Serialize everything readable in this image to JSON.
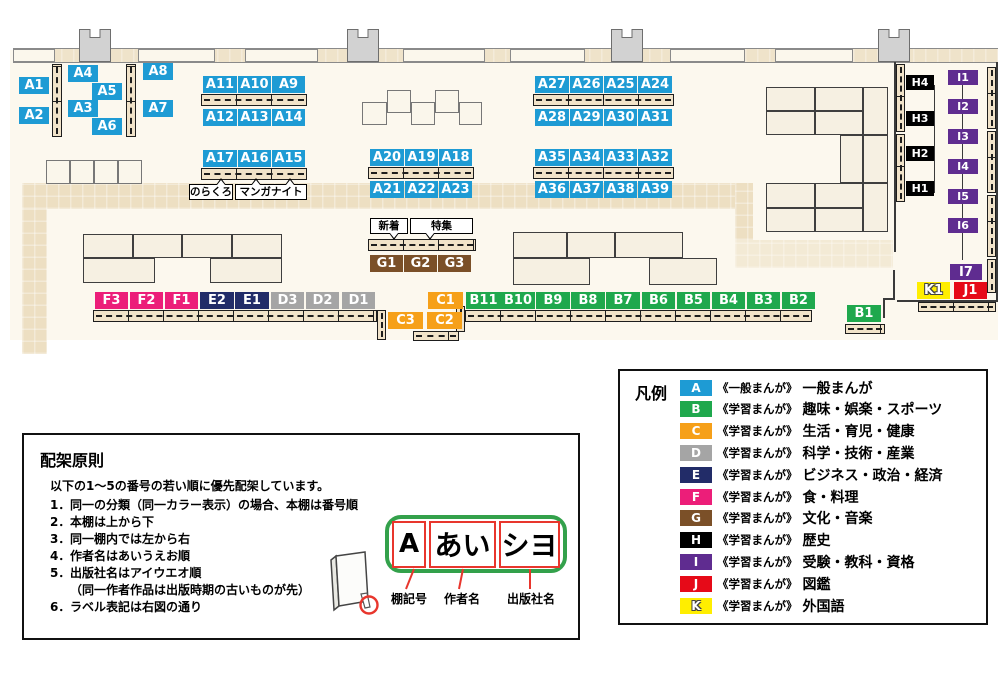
{
  "colors": {
    "A": "#1E9BD4",
    "B": "#1FA84D",
    "C": "#F6A019",
    "D": "#A5A5A5",
    "E": "#222C68",
    "F": "#EC1E79",
    "G": "#7B5028",
    "H": "#000000",
    "I": "#5F2C90",
    "J": "#E60A18",
    "K": "#FFEE00"
  },
  "map": {
    "furniture": [
      {
        "t": "floor",
        "x": 10,
        "y": 50,
        "w": 988,
        "h": 290
      },
      {
        "t": "band",
        "x": 22,
        "y": 183,
        "w": 713,
        "h": 26
      },
      {
        "t": "band",
        "x": 22,
        "y": 209,
        "w": 25,
        "h": 145
      },
      {
        "t": "band",
        "x": 735,
        "y": 183,
        "w": 18,
        "h": 57
      },
      {
        "t": "band",
        "x": 735,
        "y": 240,
        "w": 158,
        "h": 28,
        "light": true
      },
      {
        "t": "wallstrip",
        "x": 13,
        "y": 48,
        "w": 985,
        "h": 15
      },
      {
        "t": "window",
        "x": 13,
        "y": 49,
        "w": 42,
        "h": 13
      },
      {
        "t": "window",
        "x": 138,
        "y": 49,
        "w": 77,
        "h": 13
      },
      {
        "t": "window",
        "x": 245,
        "y": 49,
        "w": 73,
        "h": 13
      },
      {
        "t": "window",
        "x": 403,
        "y": 49,
        "w": 82,
        "h": 13
      },
      {
        "t": "window",
        "x": 510,
        "y": 49,
        "w": 75,
        "h": 13
      },
      {
        "t": "window",
        "x": 670,
        "y": 49,
        "w": 75,
        "h": 13
      },
      {
        "t": "window",
        "x": 775,
        "y": 49,
        "w": 78,
        "h": 13
      },
      {
        "t": "pillar",
        "x": 79,
        "y": 29,
        "w": 32,
        "h": 33
      },
      {
        "t": "pillar",
        "x": 347,
        "y": 29,
        "w": 32,
        "h": 33
      },
      {
        "t": "pillar",
        "x": 611,
        "y": 29,
        "w": 32,
        "h": 33
      },
      {
        "t": "pillar",
        "x": 878,
        "y": 29,
        "w": 32,
        "h": 33
      },
      {
        "t": "block",
        "x": 83,
        "y": 234,
        "w": 50,
        "h": 24
      },
      {
        "t": "block",
        "x": 133,
        "y": 234,
        "w": 49,
        "h": 24
      },
      {
        "t": "block",
        "x": 182,
        "y": 234,
        "w": 50,
        "h": 24
      },
      {
        "t": "block",
        "x": 232,
        "y": 234,
        "w": 50,
        "h": 24
      },
      {
        "t": "block",
        "x": 83,
        "y": 258,
        "w": 72,
        "h": 25
      },
      {
        "t": "block",
        "x": 210,
        "y": 258,
        "w": 72,
        "h": 25
      },
      {
        "t": "block",
        "x": 513,
        "y": 232,
        "w": 54,
        "h": 26
      },
      {
        "t": "block",
        "x": 567,
        "y": 232,
        "w": 48,
        "h": 26
      },
      {
        "t": "block",
        "x": 615,
        "y": 232,
        "w": 68,
        "h": 26
      },
      {
        "t": "block",
        "x": 513,
        "y": 258,
        "w": 77,
        "h": 27
      },
      {
        "t": "block",
        "x": 649,
        "y": 258,
        "w": 68,
        "h": 27
      },
      {
        "t": "block",
        "x": 766,
        "y": 87,
        "w": 49,
        "h": 24
      },
      {
        "t": "block",
        "x": 815,
        "y": 87,
        "w": 48,
        "h": 24
      },
      {
        "t": "block",
        "x": 766,
        "y": 111,
        "w": 49,
        "h": 24
      },
      {
        "t": "block",
        "x": 815,
        "y": 111,
        "w": 48,
        "h": 24
      },
      {
        "t": "block",
        "x": 863,
        "y": 87,
        "w": 25,
        "h": 48
      },
      {
        "t": "block",
        "x": 840,
        "y": 135,
        "w": 23,
        "h": 48
      },
      {
        "t": "block",
        "x": 863,
        "y": 135,
        "w": 25,
        "h": 48
      },
      {
        "t": "block",
        "x": 766,
        "y": 183,
        "w": 49,
        "h": 25
      },
      {
        "t": "block",
        "x": 815,
        "y": 183,
        "w": 48,
        "h": 25
      },
      {
        "t": "block",
        "x": 766,
        "y": 208,
        "w": 49,
        "h": 24
      },
      {
        "t": "block",
        "x": 815,
        "y": 208,
        "w": 48,
        "h": 24
      },
      {
        "t": "block",
        "x": 863,
        "y": 183,
        "w": 25,
        "h": 49
      },
      {
        "t": "sq",
        "x": 46,
        "y": 160,
        "w": 24,
        "h": 24
      },
      {
        "t": "sq",
        "x": 70,
        "y": 160,
        "w": 24,
        "h": 24
      },
      {
        "t": "sq",
        "x": 94,
        "y": 160,
        "w": 24,
        "h": 24
      },
      {
        "t": "sq",
        "x": 118,
        "y": 160,
        "w": 24,
        "h": 24
      },
      {
        "t": "sq",
        "x": 362,
        "y": 102,
        "w": 25,
        "h": 23
      },
      {
        "t": "sq",
        "x": 387,
        "y": 90,
        "w": 24,
        "h": 23
      },
      {
        "t": "sq",
        "x": 411,
        "y": 102,
        "w": 24,
        "h": 23
      },
      {
        "t": "sq",
        "x": 435,
        "y": 90,
        "w": 24,
        "h": 23
      },
      {
        "t": "sq",
        "x": 459,
        "y": 102,
        "w": 23,
        "h": 23
      },
      {
        "t": "vstrip",
        "x": 52,
        "y": 64,
        "w": 10,
        "h": 73
      },
      {
        "t": "vstrip",
        "x": 126,
        "y": 64,
        "w": 10,
        "h": 73
      },
      {
        "t": "hstrip",
        "x": 201,
        "y": 94,
        "w": 106,
        "h": 12
      },
      {
        "t": "hstrip",
        "x": 201,
        "y": 168,
        "w": 106,
        "h": 12
      },
      {
        "t": "hstrip",
        "x": 533,
        "y": 94,
        "w": 141,
        "h": 12
      },
      {
        "t": "hstrip",
        "x": 368,
        "y": 167,
        "w": 106,
        "h": 12
      },
      {
        "t": "hstrip",
        "x": 533,
        "y": 167,
        "w": 141,
        "h": 12
      },
      {
        "t": "hstrip",
        "x": 368,
        "y": 239,
        "w": 108,
        "h": 12
      },
      {
        "t": "hstrip",
        "x": 93,
        "y": 310,
        "w": 284,
        "h": 12
      },
      {
        "t": "vstrip",
        "x": 377,
        "y": 310,
        "w": 9,
        "h": 30
      },
      {
        "t": "vstrip",
        "x": 456,
        "y": 306,
        "w": 9,
        "h": 26
      },
      {
        "t": "hstrip",
        "x": 413,
        "y": 331,
        "w": 46,
        "h": 10
      },
      {
        "t": "hstrip",
        "x": 465,
        "y": 310,
        "w": 347,
        "h": 12
      },
      {
        "t": "hstrip",
        "x": 845,
        "y": 324,
        "w": 40,
        "h": 10
      },
      {
        "t": "hstrip",
        "x": 918,
        "y": 302,
        "w": 78,
        "h": 10
      },
      {
        "t": "vstrip",
        "x": 896,
        "y": 64,
        "w": 9,
        "h": 68
      },
      {
        "t": "vstrip",
        "x": 896,
        "y": 134,
        "w": 9,
        "h": 68
      },
      {
        "t": "vstrip",
        "x": 987,
        "y": 67,
        "w": 9,
        "h": 62
      },
      {
        "t": "vstrip",
        "x": 987,
        "y": 131,
        "w": 9,
        "h": 62
      },
      {
        "t": "vstrip",
        "x": 987,
        "y": 195,
        "w": 9,
        "h": 62
      },
      {
        "t": "vstrip",
        "x": 987,
        "y": 259,
        "w": 9,
        "h": 34
      },
      {
        "t": "wline",
        "x": 894,
        "y": 62,
        "w": 2,
        "h": 190
      },
      {
        "t": "wline",
        "x": 893,
        "y": 270,
        "w": 2,
        "h": 30
      },
      {
        "t": "wline",
        "x": 883,
        "y": 298,
        "w": 12,
        "h": 2
      },
      {
        "t": "wline",
        "x": 883,
        "y": 300,
        "w": 2,
        "h": 18
      },
      {
        "t": "wline",
        "x": 897,
        "y": 300,
        "w": 100,
        "h": 2
      },
      {
        "t": "wline",
        "x": 996,
        "y": 62,
        "w": 2,
        "h": 240
      },
      {
        "t": "wline",
        "x": 934,
        "y": 85,
        "w": 1,
        "h": 108
      },
      {
        "t": "wline",
        "x": 962,
        "y": 82,
        "w": 1,
        "h": 178
      }
    ],
    "shelf_labels": [
      {
        "text": "A1",
        "x": 19,
        "y": 77,
        "w": 30,
        "h": 17
      },
      {
        "text": "A2",
        "x": 19,
        "y": 107,
        "w": 30,
        "h": 17
      },
      {
        "text": "A4",
        "x": 68,
        "y": 65,
        "w": 30,
        "h": 17
      },
      {
        "text": "A3",
        "x": 68,
        "y": 100,
        "w": 30,
        "h": 17
      },
      {
        "text": "A5",
        "x": 92,
        "y": 83,
        "w": 30,
        "h": 17
      },
      {
        "text": "A6",
        "x": 92,
        "y": 118,
        "w": 30,
        "h": 17
      },
      {
        "text": "A8",
        "x": 143,
        "y": 63,
        "w": 30,
        "h": 17
      },
      {
        "text": "A7",
        "x": 143,
        "y": 100,
        "w": 30,
        "h": 17
      },
      {
        "text": "A11",
        "x": 203,
        "y": 76,
        "w": 34,
        "h": 17
      },
      {
        "text": "A10",
        "x": 238,
        "y": 76,
        "w": 33,
        "h": 17
      },
      {
        "text": "A9",
        "x": 272,
        "y": 76,
        "w": 33,
        "h": 17
      },
      {
        "text": "A12",
        "x": 203,
        "y": 109,
        "w": 34,
        "h": 17
      },
      {
        "text": "A13",
        "x": 238,
        "y": 109,
        "w": 33,
        "h": 17
      },
      {
        "text": "A14",
        "x": 272,
        "y": 109,
        "w": 33,
        "h": 17
      },
      {
        "text": "A17",
        "x": 203,
        "y": 150,
        "w": 34,
        "h": 17
      },
      {
        "text": "A16",
        "x": 238,
        "y": 150,
        "w": 33,
        "h": 17
      },
      {
        "text": "A15",
        "x": 272,
        "y": 150,
        "w": 33,
        "h": 17
      },
      {
        "text": "A20",
        "x": 370,
        "y": 149,
        "w": 34,
        "h": 17
      },
      {
        "text": "A19",
        "x": 405,
        "y": 149,
        "w": 33,
        "h": 17
      },
      {
        "text": "A18",
        "x": 439,
        "y": 149,
        "w": 33,
        "h": 17
      },
      {
        "text": "A21",
        "x": 370,
        "y": 181,
        "w": 34,
        "h": 17
      },
      {
        "text": "A22",
        "x": 405,
        "y": 181,
        "w": 33,
        "h": 17
      },
      {
        "text": "A23",
        "x": 439,
        "y": 181,
        "w": 33,
        "h": 17
      },
      {
        "text": "A27",
        "x": 535,
        "y": 76,
        "w": 34,
        "h": 17
      },
      {
        "text": "A26",
        "x": 570,
        "y": 76,
        "w": 33,
        "h": 17
      },
      {
        "text": "A25",
        "x": 604,
        "y": 76,
        "w": 33,
        "h": 17
      },
      {
        "text": "A24",
        "x": 638,
        "y": 76,
        "w": 34,
        "h": 17
      },
      {
        "text": "A28",
        "x": 535,
        "y": 109,
        "w": 34,
        "h": 17
      },
      {
        "text": "A29",
        "x": 570,
        "y": 109,
        "w": 33,
        "h": 17
      },
      {
        "text": "A30",
        "x": 604,
        "y": 109,
        "w": 33,
        "h": 17
      },
      {
        "text": "A31",
        "x": 638,
        "y": 109,
        "w": 34,
        "h": 17
      },
      {
        "text": "A35",
        "x": 535,
        "y": 149,
        "w": 34,
        "h": 17
      },
      {
        "text": "A34",
        "x": 570,
        "y": 149,
        "w": 33,
        "h": 17
      },
      {
        "text": "A33",
        "x": 604,
        "y": 149,
        "w": 33,
        "h": 17
      },
      {
        "text": "A32",
        "x": 638,
        "y": 149,
        "w": 34,
        "h": 17
      },
      {
        "text": "A36",
        "x": 535,
        "y": 181,
        "w": 34,
        "h": 17
      },
      {
        "text": "A37",
        "x": 570,
        "y": 181,
        "w": 33,
        "h": 17
      },
      {
        "text": "A38",
        "x": 604,
        "y": 181,
        "w": 33,
        "h": 17
      },
      {
        "text": "A39",
        "x": 638,
        "y": 181,
        "w": 34,
        "h": 17
      },
      {
        "text": "G1",
        "x": 370,
        "y": 255,
        "w": 33,
        "h": 17
      },
      {
        "text": "G2",
        "x": 404,
        "y": 255,
        "w": 33,
        "h": 17
      },
      {
        "text": "G3",
        "x": 438,
        "y": 255,
        "w": 33,
        "h": 17
      },
      {
        "text": "F3",
        "x": 95,
        "y": 292,
        "w": 33,
        "h": 17
      },
      {
        "text": "F2",
        "x": 130,
        "y": 292,
        "w": 33,
        "h": 17
      },
      {
        "text": "F1",
        "x": 165,
        "y": 292,
        "w": 33,
        "h": 17
      },
      {
        "text": "E2",
        "x": 200,
        "y": 292,
        "w": 34,
        "h": 17
      },
      {
        "text": "E1",
        "x": 235,
        "y": 292,
        "w": 34,
        "h": 17
      },
      {
        "text": "D3",
        "x": 271,
        "y": 292,
        "w": 33,
        "h": 17
      },
      {
        "text": "D2",
        "x": 306,
        "y": 292,
        "w": 33,
        "h": 17
      },
      {
        "text": "D1",
        "x": 342,
        "y": 292,
        "w": 33,
        "h": 17
      },
      {
        "text": "C1",
        "x": 428,
        "y": 292,
        "w": 35,
        "h": 17
      },
      {
        "text": "C3",
        "x": 388,
        "y": 312,
        "w": 35,
        "h": 17
      },
      {
        "text": "C2",
        "x": 427,
        "y": 312,
        "w": 35,
        "h": 17
      },
      {
        "text": "B11",
        "x": 466,
        "y": 292,
        "w": 35,
        "h": 17
      },
      {
        "text": "B10",
        "x": 501,
        "y": 292,
        "w": 34,
        "h": 17
      },
      {
        "text": "B9",
        "x": 536,
        "y": 292,
        "w": 34,
        "h": 17
      },
      {
        "text": "B8",
        "x": 571,
        "y": 292,
        "w": 34,
        "h": 17
      },
      {
        "text": "B7",
        "x": 606,
        "y": 292,
        "w": 34,
        "h": 17
      },
      {
        "text": "B6",
        "x": 642,
        "y": 292,
        "w": 33,
        "h": 17
      },
      {
        "text": "B5",
        "x": 677,
        "y": 292,
        "w": 33,
        "h": 17
      },
      {
        "text": "B4",
        "x": 712,
        "y": 292,
        "w": 33,
        "h": 17
      },
      {
        "text": "B3",
        "x": 747,
        "y": 292,
        "w": 33,
        "h": 17
      },
      {
        "text": "B2",
        "x": 782,
        "y": 292,
        "w": 33,
        "h": 17
      },
      {
        "text": "B1",
        "x": 847,
        "y": 305,
        "w": 34,
        "h": 17
      },
      {
        "text": "H4",
        "x": 906,
        "y": 75,
        "w": 28,
        "h": 15
      },
      {
        "text": "H3",
        "x": 906,
        "y": 111,
        "w": 28,
        "h": 15
      },
      {
        "text": "H2",
        "x": 906,
        "y": 146,
        "w": 28,
        "h": 15
      },
      {
        "text": "H1",
        "x": 906,
        "y": 181,
        "w": 28,
        "h": 15
      },
      {
        "text": "I1",
        "x": 948,
        "y": 70,
        "w": 30,
        "h": 15
      },
      {
        "text": "I2",
        "x": 948,
        "y": 99,
        "w": 30,
        "h": 15
      },
      {
        "text": "I3",
        "x": 948,
        "y": 129,
        "w": 30,
        "h": 15
      },
      {
        "text": "I4",
        "x": 948,
        "y": 159,
        "w": 30,
        "h": 15
      },
      {
        "text": "I5",
        "x": 948,
        "y": 189,
        "w": 30,
        "h": 15
      },
      {
        "text": "I6",
        "x": 948,
        "y": 218,
        "w": 30,
        "h": 15
      },
      {
        "text": "I7",
        "x": 950,
        "y": 264,
        "w": 32,
        "h": 16
      },
      {
        "text": "K1",
        "x": 917,
        "y": 282,
        "w": 33,
        "h": 17
      },
      {
        "text": "J1",
        "x": 954,
        "y": 282,
        "w": 33,
        "h": 17
      }
    ],
    "tags": [
      {
        "text": "のらくろ",
        "x": 189,
        "y": 184,
        "w": 44,
        "h": 16,
        "tails": [
          {
            "dir": "up",
            "pos": 0.7
          }
        ]
      },
      {
        "text": "マンガナイト",
        "x": 235,
        "y": 184,
        "w": 72,
        "h": 16,
        "tails": [
          {
            "dir": "up",
            "pos": 0.28
          },
          {
            "dir": "up",
            "pos": 0.75
          }
        ]
      },
      {
        "text": "新着",
        "x": 370,
        "y": 218,
        "w": 38,
        "h": 16,
        "tails": [
          {
            "dir": "down",
            "pos": 0.6
          }
        ]
      },
      {
        "text": "特集",
        "x": 410,
        "y": 218,
        "w": 63,
        "h": 16,
        "tails": [
          {
            "dir": "down",
            "pos": 0.3
          }
        ]
      }
    ]
  },
  "legend": {
    "title": "凡例",
    "rows": [
      {
        "letter": "A",
        "tag": "《一般まんが》",
        "label": "一般まんが"
      },
      {
        "letter": "B",
        "tag": "《学習まんが》",
        "label": "趣味・娯楽・スポーツ"
      },
      {
        "letter": "C",
        "tag": "《学習まんが》",
        "label": "生活・育児・健康"
      },
      {
        "letter": "D",
        "tag": "《学習まんが》",
        "label": "科学・技術・産業"
      },
      {
        "letter": "E",
        "tag": "《学習まんが》",
        "label": "ビジネス・政治・経済"
      },
      {
        "letter": "F",
        "tag": "《学習まんが》",
        "label": "食・料理"
      },
      {
        "letter": "G",
        "tag": "《学習まんが》",
        "label": "文化・音楽"
      },
      {
        "letter": "H",
        "tag": "《学習まんが》",
        "label": "歴史"
      },
      {
        "letter": "I",
        "tag": "《学習まんが》",
        "label": "受験・教科・資格"
      },
      {
        "letter": "J",
        "tag": "《学習まんが》",
        "label": "図鑑"
      },
      {
        "letter": "K",
        "tag": "《学習まんが》",
        "label": "外国語"
      }
    ]
  },
  "principles": {
    "title": "配架原則",
    "intro": "以下の1～5の番号の若い順に優先配架しています。",
    "items": [
      {
        "n": "1．",
        "text": "同一の分類（同一カラー表示）の場合、本棚は番号順"
      },
      {
        "n": "2．",
        "text": "本棚は上から下"
      },
      {
        "n": "3．",
        "text": "同一棚内では左から右"
      },
      {
        "n": "4．",
        "text": "作者名はあいうえお順"
      },
      {
        "n": "5．",
        "text": "出版社名はアイウエオ順"
      },
      {
        "n": "",
        "text": "（同一作者作品は出版時期の古いものが先）",
        "indent": true
      },
      {
        "n": "6．",
        "text": "ラベル表記は右図の通り"
      }
    ],
    "diagram": {
      "segments": [
        "A",
        "あい",
        "シヨ"
      ],
      "captions": [
        "棚記号",
        "作者名",
        "出版社名"
      ]
    }
  }
}
